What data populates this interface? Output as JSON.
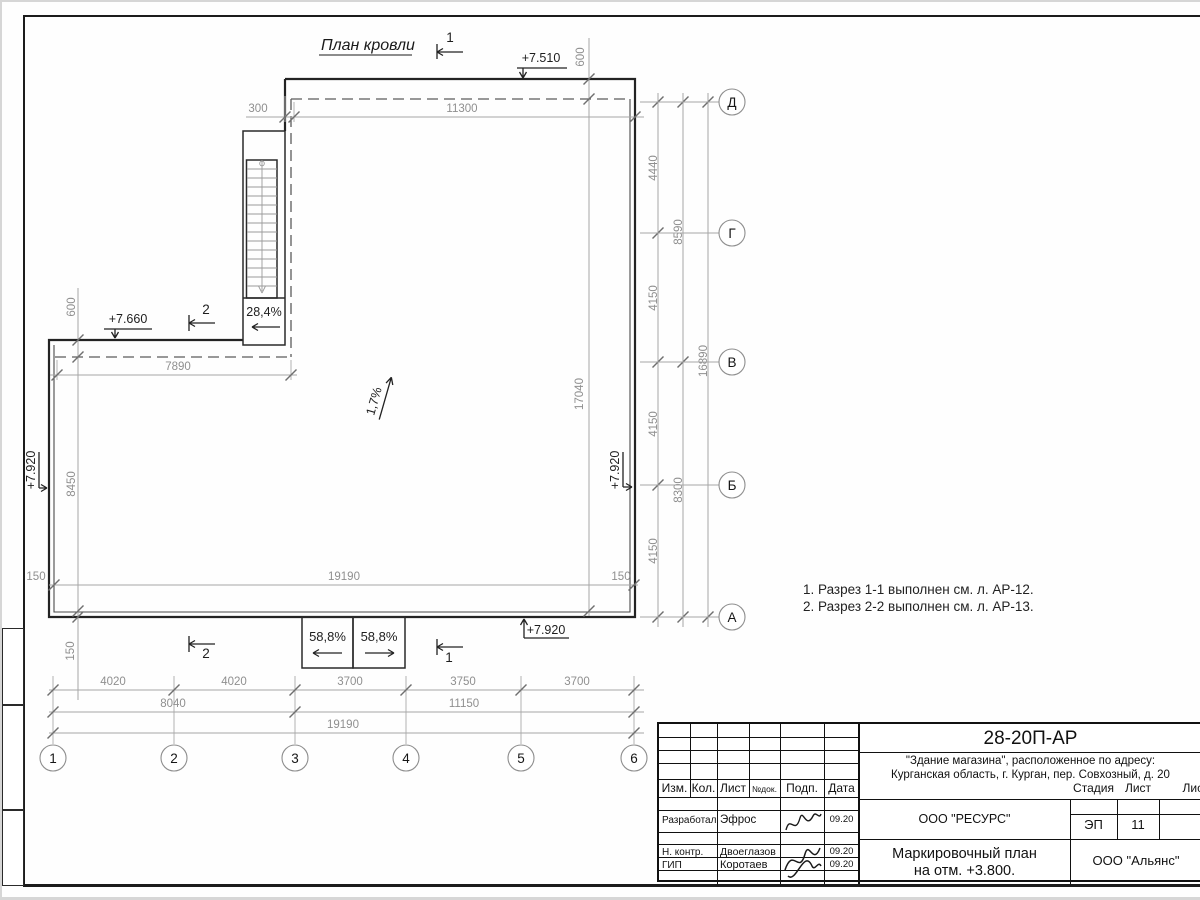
{
  "page": {
    "title": "План кровли"
  },
  "notes": {
    "line1": "1. Разрез 1-1 выполнен см. л. АР-12.",
    "line2": "2. Разрез 2-2 выполнен см. л. АР-13."
  },
  "slopes": {
    "roof": "1,7%",
    "ramp": "28,4%",
    "canopy_left": "58,8%",
    "canopy_right": "58,8%"
  },
  "elevations": {
    "roof_high": "+7.510",
    "wing": "+7.660",
    "parapet_left": "+7.920",
    "parapet_right": "+7.920",
    "parapet_bottom": "+7.920"
  },
  "sections": {
    "s1": "1",
    "s2": "2"
  },
  "axes": {
    "h": [
      "1",
      "2",
      "3",
      "4",
      "5",
      "6"
    ],
    "v": [
      "Д",
      "Г",
      "В",
      "Б",
      "А"
    ]
  },
  "dims": {
    "top_300": "300",
    "top_11300": "11300",
    "top_600": "600",
    "wing_600": "600",
    "wing_7890": "7890",
    "left_8450": "8450",
    "left_150_bottom": "150",
    "inner_17040": "17040",
    "inner_19190": "19190",
    "inner_150_left": "150",
    "inner_150_right": "150",
    "right_4440": "4440",
    "right_4150_a": "4150",
    "right_4150_b": "4150",
    "right_4150_c": "4150",
    "right_8590": "8590",
    "right_8300": "8300",
    "right_16890": "16890",
    "bot_4020_a": "4020",
    "bot_4020_b": "4020",
    "bot_3700_a": "3700",
    "bot_3750": "3750",
    "bot_3700_b": "3700",
    "bot_8040": "8040",
    "bot_11150": "11150",
    "bot_19190": "19190"
  },
  "titleblock": {
    "doc_number": "28-20П-АР",
    "project_line1": "\"Здание магазина\", расположенное по адресу:",
    "project_line2": "Курганская область, г. Курган, пер. Совхозный, д. 20",
    "designer_org": "ООО \"РЕСУРС\"",
    "client_org": "ООО \"Альянс\"",
    "sheet_name_line1": "Маркировочный план",
    "sheet_name_line2": "на отм. +3.800.",
    "col_izm": "Изм.",
    "col_kol": "Кол.",
    "col_list": "Лист",
    "col_ndok": "№док.",
    "col_podp": "Подп.",
    "col_data": "Дата",
    "stage_label": "Стадия",
    "sheet_label": "Лист",
    "sheets_label": "Листов",
    "stage_value": "ЭП",
    "sheet_value": "11",
    "row_developer_role": "Разработал",
    "row_developer_name": "Эфрос",
    "row_developer_date": "09.20",
    "row_ncontr_role": "Н. контр.",
    "row_ncontr_name": "Двоеглазов",
    "row_ncontr_date": "09.20",
    "row_gip_role": "ГИП",
    "row_gip_name": "Коротаев",
    "row_gip_date": "09.20"
  }
}
